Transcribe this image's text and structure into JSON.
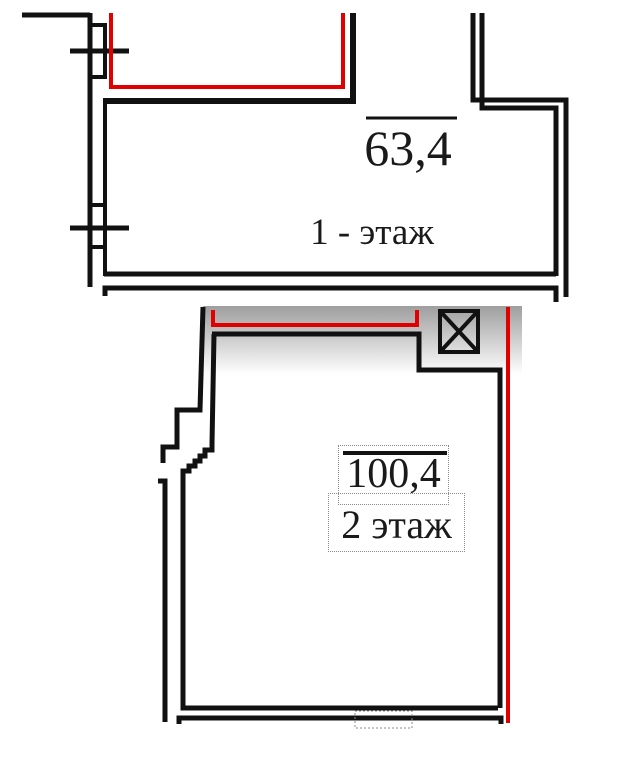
{
  "floorplan": {
    "floor1": {
      "area": "63,4",
      "label": "1 - этаж"
    },
    "floor2": {
      "area": "100,4",
      "label": "2 этаж"
    }
  },
  "colors": {
    "wall": "#111111",
    "red_outline": "#e00000",
    "shade_top": "#9e9e9e",
    "text": "#1a1a1a",
    "selection_dotted": "#8a8a8a",
    "background": "#ffffff"
  },
  "icons": {
    "vent_shaft_icon": "box-with-diagonal-cross"
  }
}
